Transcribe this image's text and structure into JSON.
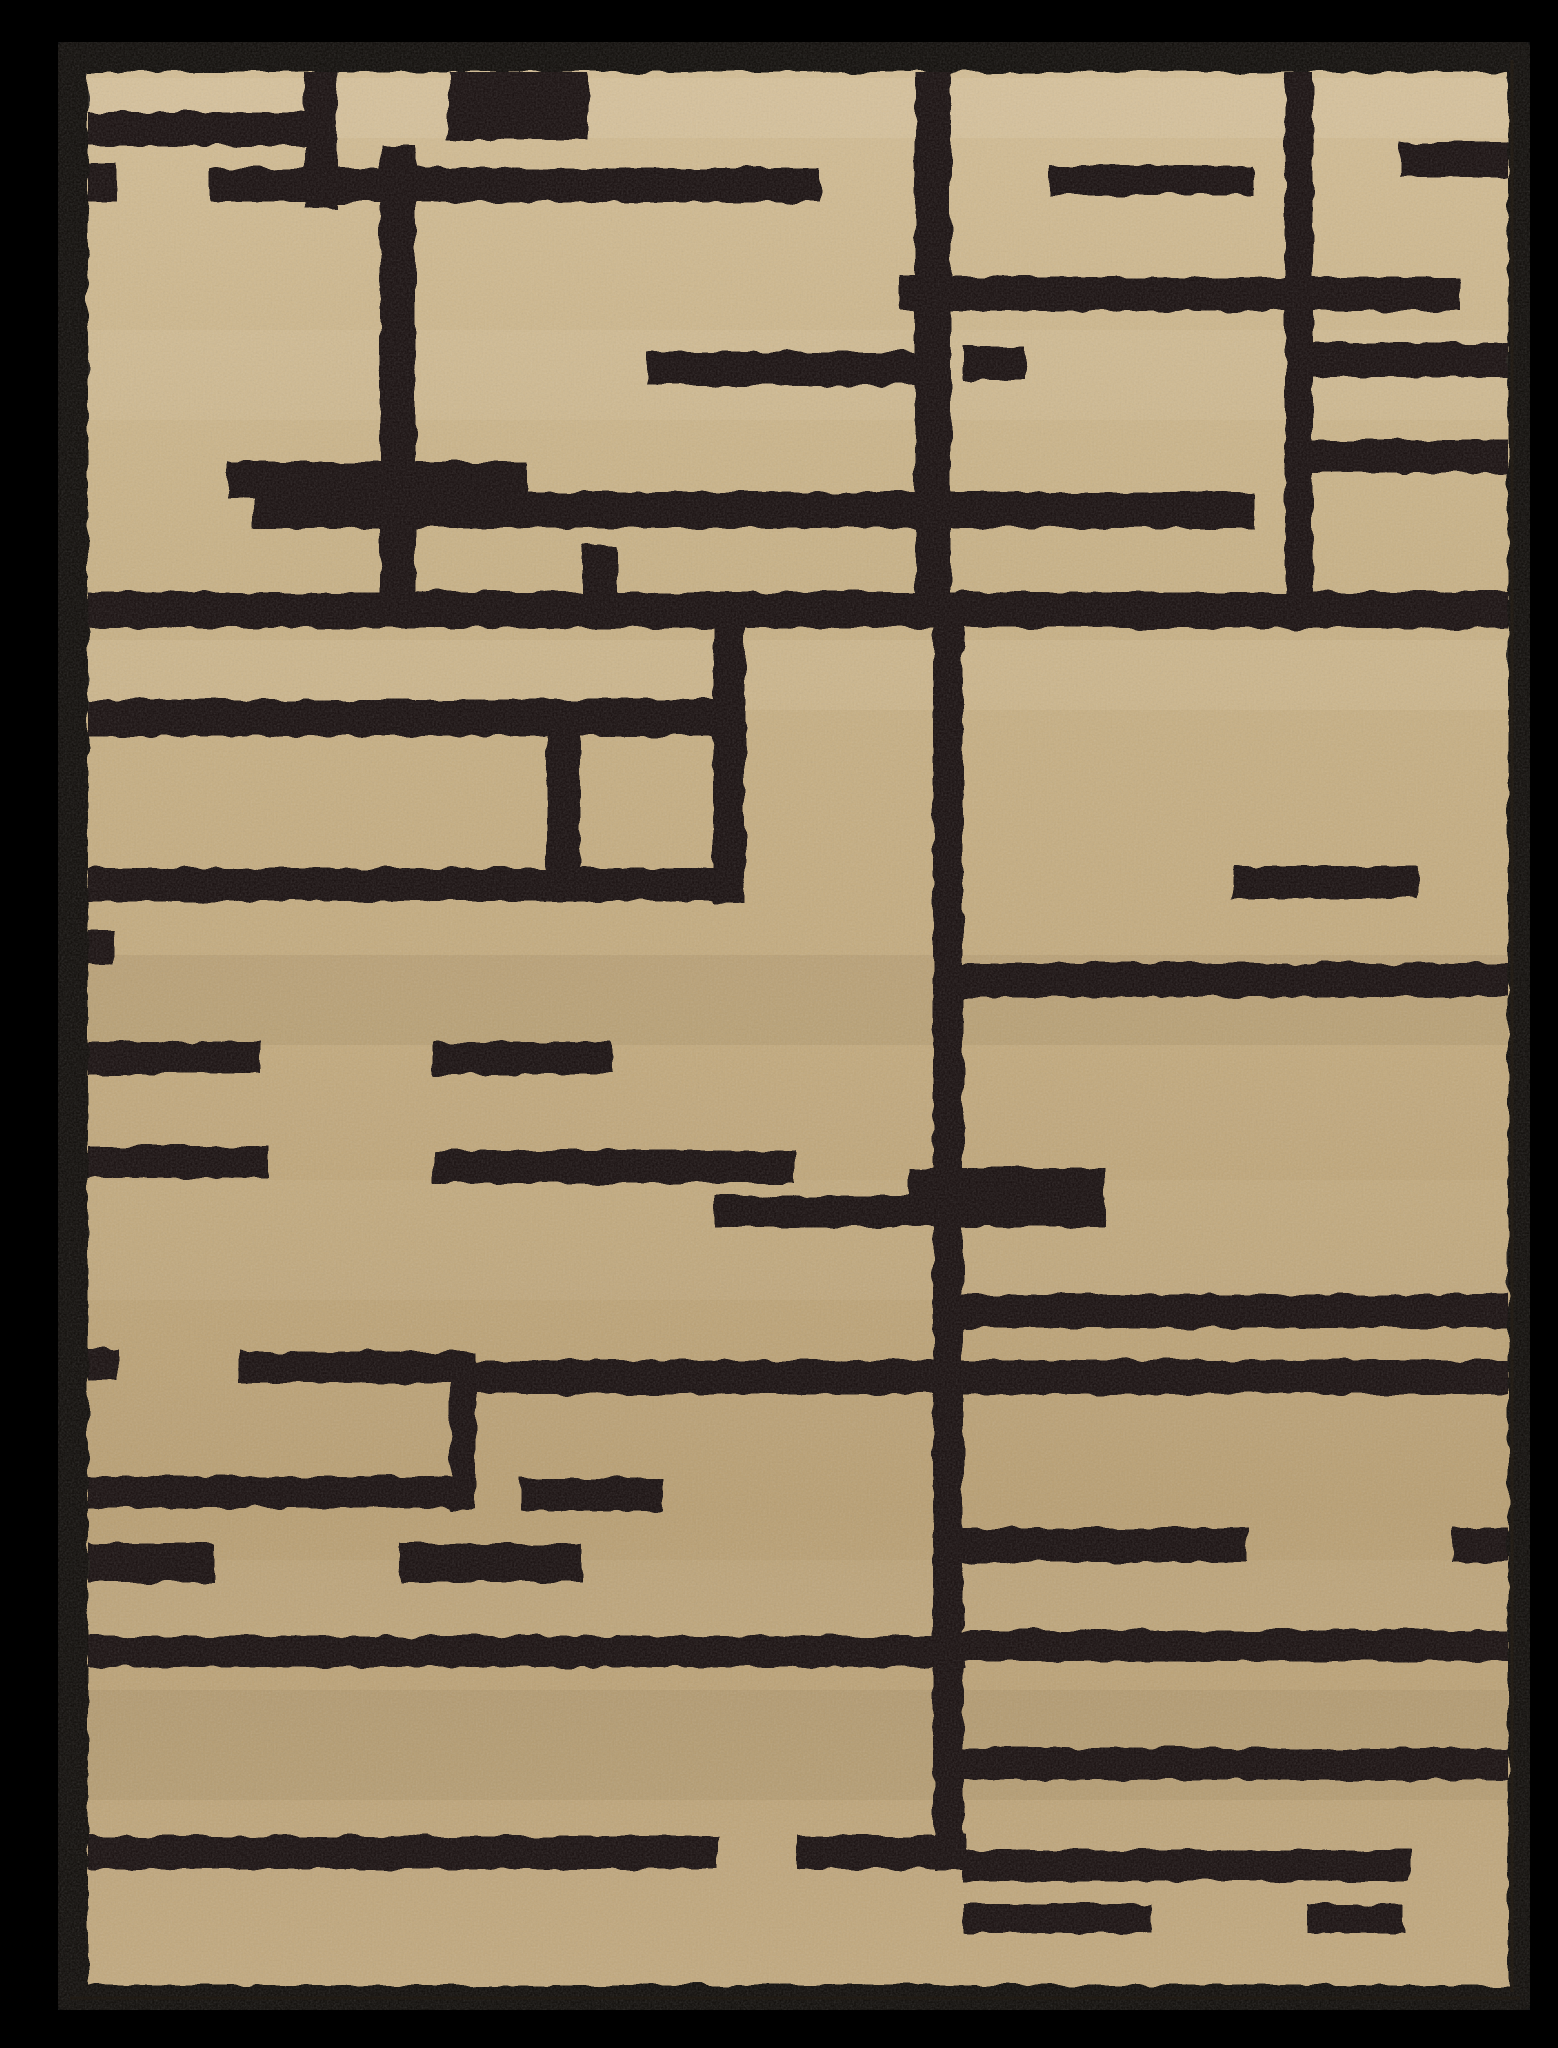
{
  "image": {
    "width": 1558,
    "height": 2048,
    "background": "#000000",
    "alt": "Overhead photo of a rectangular beige plush area rug with an abstract black geometric maze-like line pattern and a black binding border on a black background"
  },
  "rug": {
    "outer": {
      "x": 58,
      "y": 42,
      "w": 1472,
      "h": 1968,
      "color": "#0d0a07",
      "corner_radius": 5
    },
    "field": {
      "x": 88,
      "y": 72,
      "w": 1420,
      "h": 1913
    },
    "field_gradient": [
      "#d3bd94",
      "#c9b286",
      "#c3aa7d",
      "#b99f72",
      "#c2a97e"
    ],
    "pattern_color": "#16100a",
    "seam": {
      "x": 1512,
      "y1": 60,
      "y2": 1992,
      "color": "#2b2217",
      "width": 3,
      "opacity": 0.55
    },
    "seam_bottom": {
      "y": 1998,
      "x1": 70,
      "x2": 1520,
      "color": "#241c12",
      "width": 3,
      "opacity": 0.5
    },
    "grain_opacity": 0.2,
    "fuzz_scale": 9
  },
  "pattern_rects": [
    [
      88,
      112,
      220,
      34
    ],
    [
      305,
      68,
      32,
      140
    ],
    [
      88,
      164,
      30,
      38
    ],
    [
      210,
      168,
      610,
      34
    ],
    [
      448,
      66,
      140,
      74
    ],
    [
      380,
      145,
      35,
      482
    ],
    [
      583,
      545,
      34,
      50
    ],
    [
      915,
      57,
      36,
      570
    ],
    [
      900,
      277,
      560,
      34
    ],
    [
      1285,
      57,
      28,
      541
    ],
    [
      1400,
      143,
      108,
      34
    ],
    [
      1050,
      165,
      205,
      30
    ],
    [
      1285,
      343,
      223,
      34
    ],
    [
      963,
      346,
      62,
      34
    ],
    [
      1313,
      440,
      195,
      33
    ],
    [
      647,
      352,
      268,
      33
    ],
    [
      227,
      462,
      300,
      36
    ],
    [
      253,
      492,
      1002,
      36
    ],
    [
      88,
      592,
      1420,
      36
    ],
    [
      713,
      592,
      32,
      311
    ],
    [
      933,
      592,
      30,
      1278
    ],
    [
      88,
      700,
      625,
      36
    ],
    [
      547,
      702,
      33,
      168
    ],
    [
      88,
      868,
      627,
      33
    ],
    [
      1232,
      866,
      186,
      32
    ],
    [
      963,
      963,
      545,
      34
    ],
    [
      88,
      930,
      26,
      33
    ],
    [
      88,
      1042,
      172,
      32
    ],
    [
      433,
      1042,
      180,
      32
    ],
    [
      88,
      1146,
      180,
      32
    ],
    [
      433,
      1150,
      362,
      33
    ],
    [
      908,
      1168,
      196,
      33
    ],
    [
      715,
      1196,
      390,
      31
    ],
    [
      963,
      1294,
      545,
      34
    ],
    [
      470,
      1360,
      1038,
      34
    ],
    [
      238,
      1352,
      234,
      31
    ],
    [
      88,
      1350,
      30,
      30
    ],
    [
      450,
      1352,
      26,
      158
    ],
    [
      88,
      1476,
      384,
      32
    ],
    [
      520,
      1478,
      143,
      33
    ],
    [
      963,
      1528,
      284,
      34
    ],
    [
      1452,
      1528,
      56,
      34
    ],
    [
      88,
      1544,
      126,
      38
    ],
    [
      400,
      1544,
      182,
      38
    ],
    [
      88,
      1636,
      877,
      31
    ],
    [
      963,
      1630,
      545,
      31
    ],
    [
      88,
      1836,
      630,
      33
    ],
    [
      797,
      1836,
      168,
      33
    ],
    [
      963,
      1748,
      545,
      32
    ],
    [
      963,
      1850,
      446,
      31
    ],
    [
      963,
      1904,
      188,
      29
    ],
    [
      1307,
      1904,
      96,
      29
    ]
  ],
  "sheen_bands": [
    {
      "y": 78,
      "h": 60,
      "color": "#fff6e0",
      "opacity": 0.1
    },
    {
      "y": 330,
      "h": 90,
      "color": "#fff6e0",
      "opacity": 0.07
    },
    {
      "y": 640,
      "h": 70,
      "color": "#fff6e0",
      "opacity": 0.09
    },
    {
      "y": 1180,
      "h": 120,
      "color": "#fff6e0",
      "opacity": 0.06
    },
    {
      "y": 1560,
      "h": 80,
      "color": "#fff6e0",
      "opacity": 0.05
    },
    {
      "y": 955,
      "h": 90,
      "color": "#3a2a12",
      "opacity": 0.07
    },
    {
      "y": 1690,
      "h": 110,
      "color": "#3a2a12",
      "opacity": 0.06
    }
  ]
}
